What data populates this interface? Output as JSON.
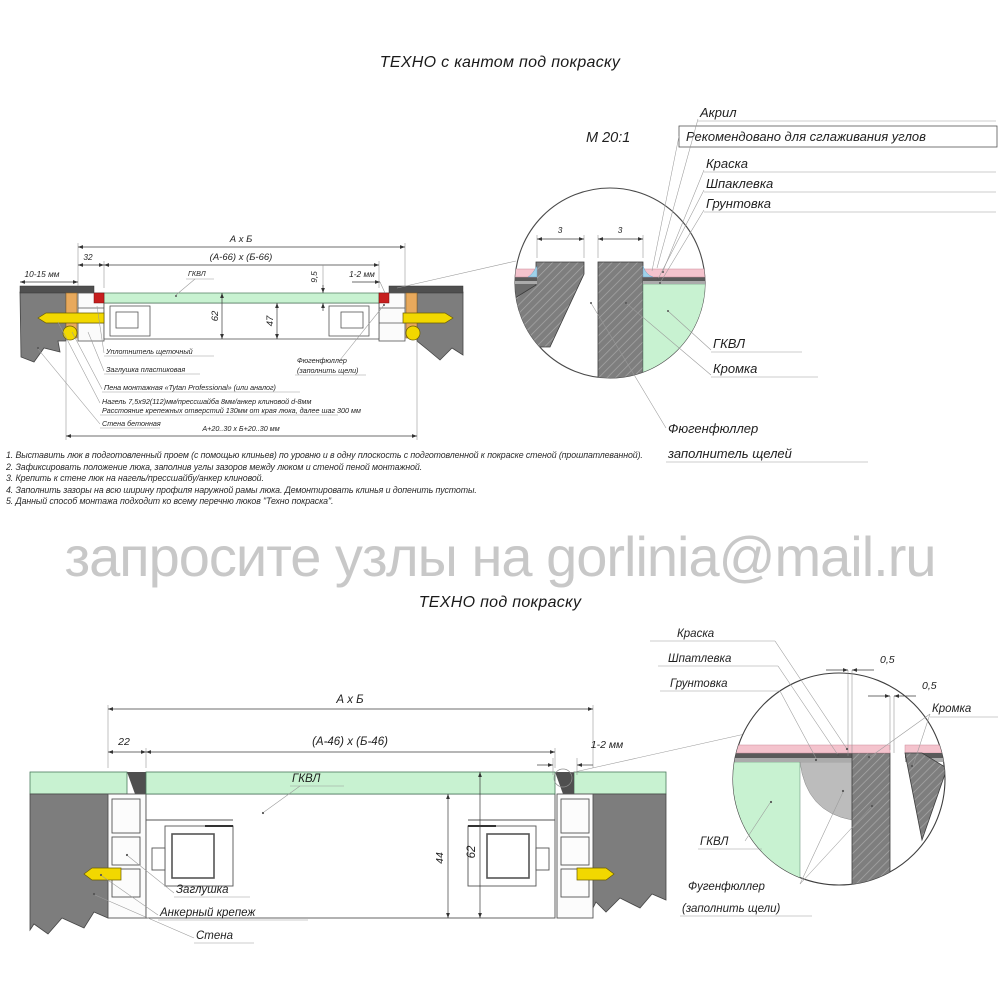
{
  "page": {
    "title_top": "ТЕХНО с кантом под покраску",
    "title_bottom": "ТЕХНО под покраску",
    "watermark": "запросите узлы на gorlinia@mail.ru"
  },
  "colors": {
    "wall_gray": "#7d7d7d",
    "finish_dark": "#4f4f4f",
    "gkvl_green": "#c8f2d1",
    "paint_pink": "#f4c3cd",
    "acrylic_blue": "#9fd2ea",
    "foam_orange": "#e8a95c",
    "anchor_yellow": "#f2d800",
    "seal_red": "#c71f1f",
    "filler_gray": "#bcbcbc",
    "watermark_gray": "#c8c8c8"
  },
  "drawing1": {
    "dims": {
      "overall": "А х Б",
      "inner": "(А-66) х (Б-66)",
      "offset": "32",
      "gap_left": "10-15 мм",
      "panel_thk": "9,5",
      "gap_right": "1-2 мм",
      "depth_total": "62",
      "depth_inner": "47",
      "opening": "А+20..30 х Б+20..30 мм"
    },
    "labels": {
      "gkvl": "ГКВЛ",
      "seal": "Уплотнитель щеточный",
      "plug": "Заглушка пластиковая",
      "foam": "Пена монтажная «Tytan Professional» (или аналог)",
      "dowel1": "Нагель 7,5х92(112)мм/прессшайба 8мм/анкер клиновой d-8мм",
      "dowel2": "Расстояние крепежных отверстий 130мм от края люка, далее шаг 300 мм",
      "wall": "Стена бетонная",
      "filler1": "Фюгенфюллер",
      "filler2": "(заполнить щели)"
    }
  },
  "detail1": {
    "scale": "М 20:1",
    "dim3a": "3",
    "dim3b": "3",
    "labels": {
      "acrylic": "Акрил",
      "recommend": "Рекомендовано для сглаживания углов",
      "paint": "Краска",
      "putty": "Шпаклевка",
      "primer": "Грунтовка",
      "gkvl": "ГКВЛ",
      "edge": "Кромка",
      "filler1": "Фюгенфюллер",
      "filler2": "заполнитель щелей"
    }
  },
  "notes": [
    "1. Выставить люк в подготовленный проем (с помощью клиньев) по уровню и в одну плоскость с подготовленной к покраске стеной (прошпатлеванной).",
    "2. Зафиксировать положение люка, заполнив углы зазоров между люком и стеной пеной монтажной.",
    "3. Крепить к стене люк на нагель/прессшайбу/анкер клиновой.",
    "4. Заполнить зазоры на всю ширину профиля наружной рамы люка. Демонтировать клинья и допенить пустоты.",
    "5. Данный способ монтажа подходит ко всему перечню люков \"Техно покраска\"."
  ],
  "drawing2": {
    "dims": {
      "overall": "А х Б",
      "inner": "(А-46) х (Б-46)",
      "offset": "22",
      "gap_right": "1-2 мм",
      "depth_inner": "44",
      "depth_total": "62"
    },
    "labels": {
      "gkvl": "ГКВЛ",
      "plug": "Заглушка",
      "anchor": "Анкерный крепеж",
      "wall": "Стена"
    }
  },
  "detail2": {
    "dim05a": "0,5",
    "dim05b": "0,5",
    "labels": {
      "paint": "Краска",
      "putty": "Шпатлевка",
      "primer": "Грунтовка",
      "edge": "Кромка",
      "gkvl": "ГКВЛ",
      "filler1": "Фугенфюллер",
      "filler2": "(заполнить щели)"
    }
  }
}
